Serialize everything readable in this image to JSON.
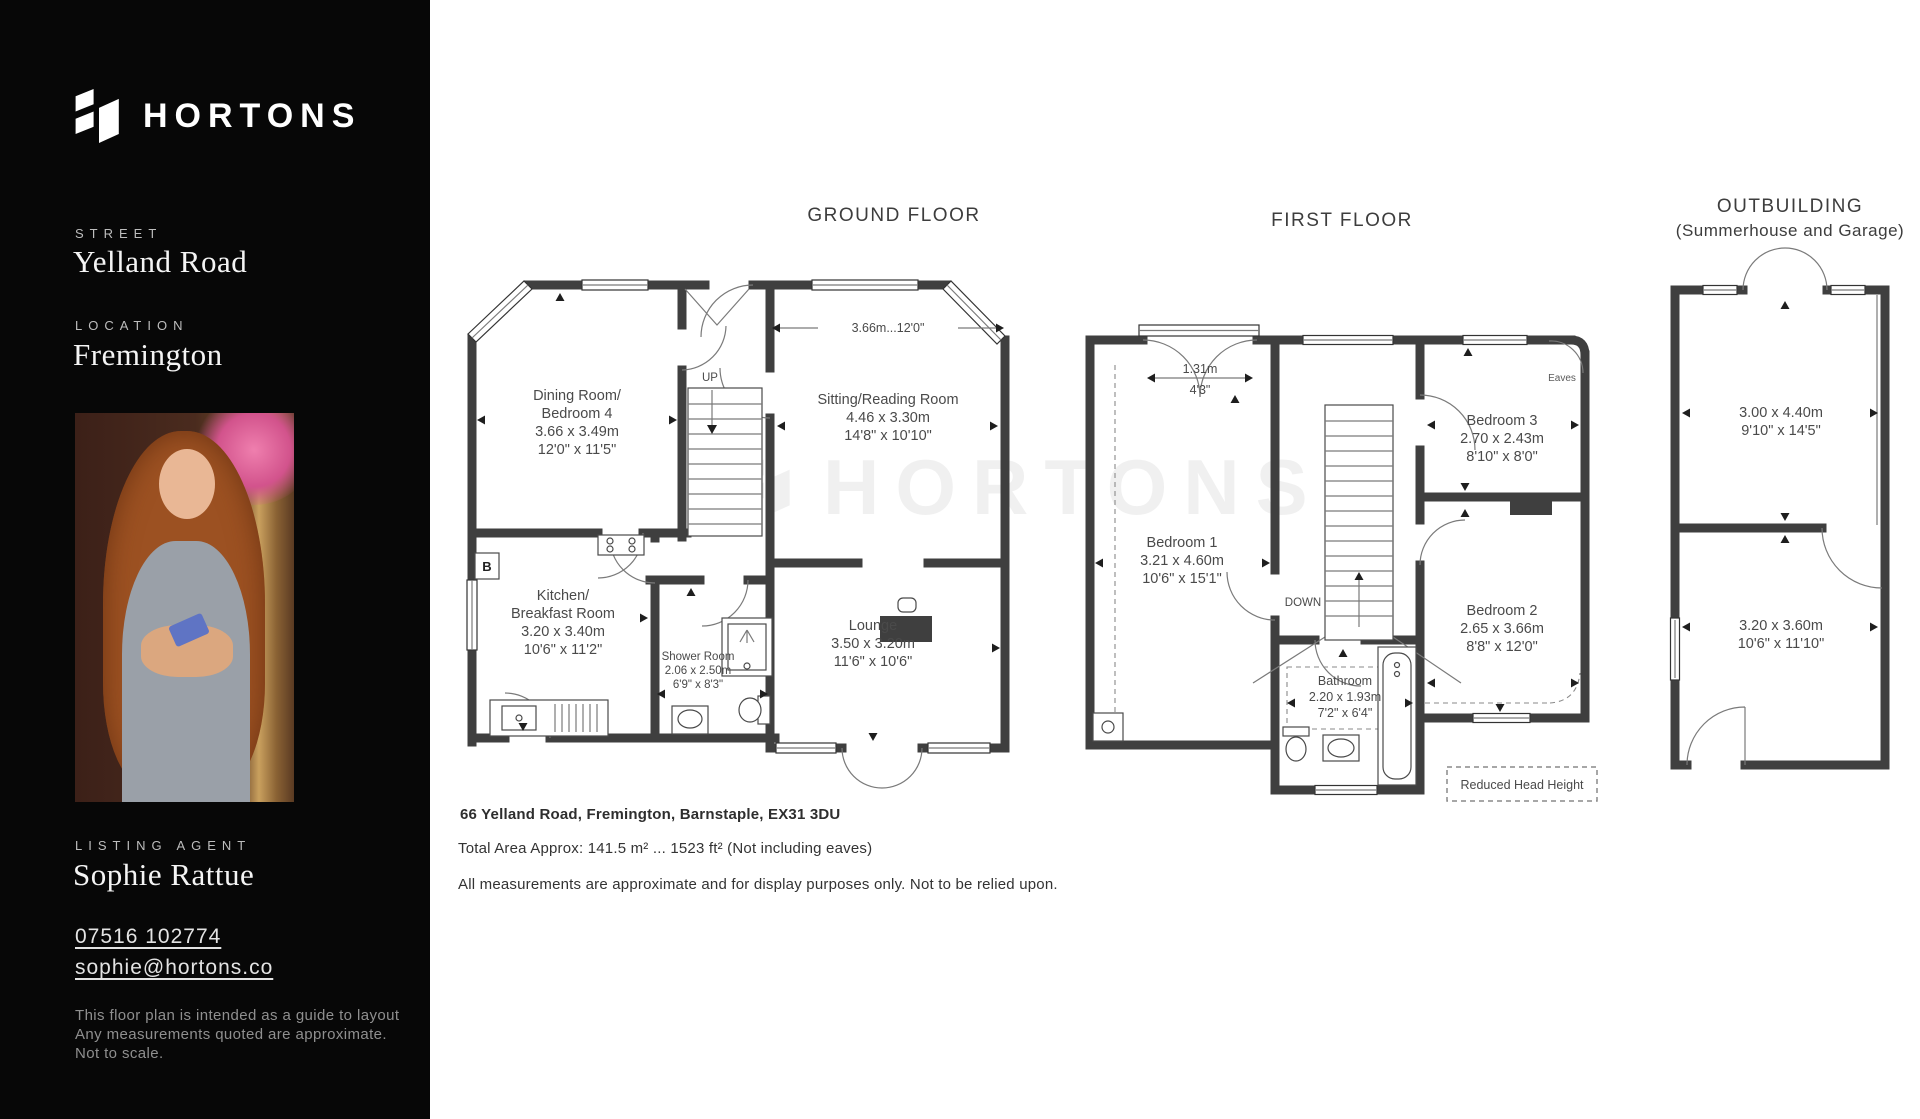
{
  "sidebar": {
    "brand": "HORTONS",
    "street_label": "STREET",
    "street": "Yelland Road",
    "location_label": "LOCATION",
    "location": "Fremington",
    "agent_label": "LISTING AGENT",
    "agent_name": "Sophie Rattue",
    "phone": "07516 102774",
    "email": "sophie@hortons.co",
    "disclaimer": [
      "This floor plan is intended  as a guide to layout",
      "Any measurements quoted are approximate.",
      "Not to scale."
    ]
  },
  "titles": {
    "ground": "GROUND FLOOR",
    "first": "FIRST FLOOR",
    "outbuilding": "OUTBUILDING",
    "outbuilding_sub": "(Summerhouse and Garage)"
  },
  "ground": {
    "dim_note": "3.66m...12'0\"",
    "up": "UP",
    "boiler": "B",
    "dining": [
      "Dining Room/",
      "Bedroom 4",
      "3.66 x 3.49m",
      "12'0\" x 11'5\""
    ],
    "sitting": [
      "Sitting/Reading Room",
      "4.46 x 3.30m",
      "14'8\" x 10'10\""
    ],
    "kitchen": [
      "Kitchen/",
      "Breakfast Room",
      "3.20 x 3.40m",
      "10'6\" x 11'2\""
    ],
    "shower": [
      "Shower Room",
      "2.06 x 2.50m",
      "6'9\" x 8'3\""
    ],
    "lounge": [
      "Lounge",
      "3.50 x 3.20m",
      "11'6\" x 10'6\""
    ]
  },
  "first": {
    "down": "DOWN",
    "eaves": "Eaves",
    "dim_m": "1.31m",
    "dim_ft": "4'3\"",
    "reduced": "Reduced Head Height",
    "bedroom1": [
      "Bedroom 1",
      "3.21 x 4.60m",
      "10'6\" x 15'1\""
    ],
    "bedroom2": [
      "Bedroom 2",
      "2.65 x 3.66m",
      "8'8\" x 12'0\""
    ],
    "bedroom3": [
      "Bedroom 3",
      "2.70 x 2.43m",
      "8'10\" x 8'0\""
    ],
    "bathroom": [
      "Bathroom",
      "2.20 x 1.93m",
      "7'2\" x 6'4\""
    ]
  },
  "outbuilding": {
    "room1": [
      "3.00 x 4.40m",
      "9'10\" x 14'5\""
    ],
    "room2": [
      "3.20 x 3.60m",
      "10'6\" x 11'10\""
    ]
  },
  "footer": {
    "address": "66 Yelland Road, Fremington, Barnstaple, EX31 3DU",
    "area": "Total Area Approx: 141.5 m² ... 1523 ft² (Not including eaves)",
    "note": "All measurements are approximate and for display purposes only. Not to be relied upon."
  },
  "watermark": "HORTONS",
  "colors": {
    "sidebar_bg": "#070707",
    "wall": "#3f3f3f",
    "plan_text": "#4a4a4a"
  }
}
